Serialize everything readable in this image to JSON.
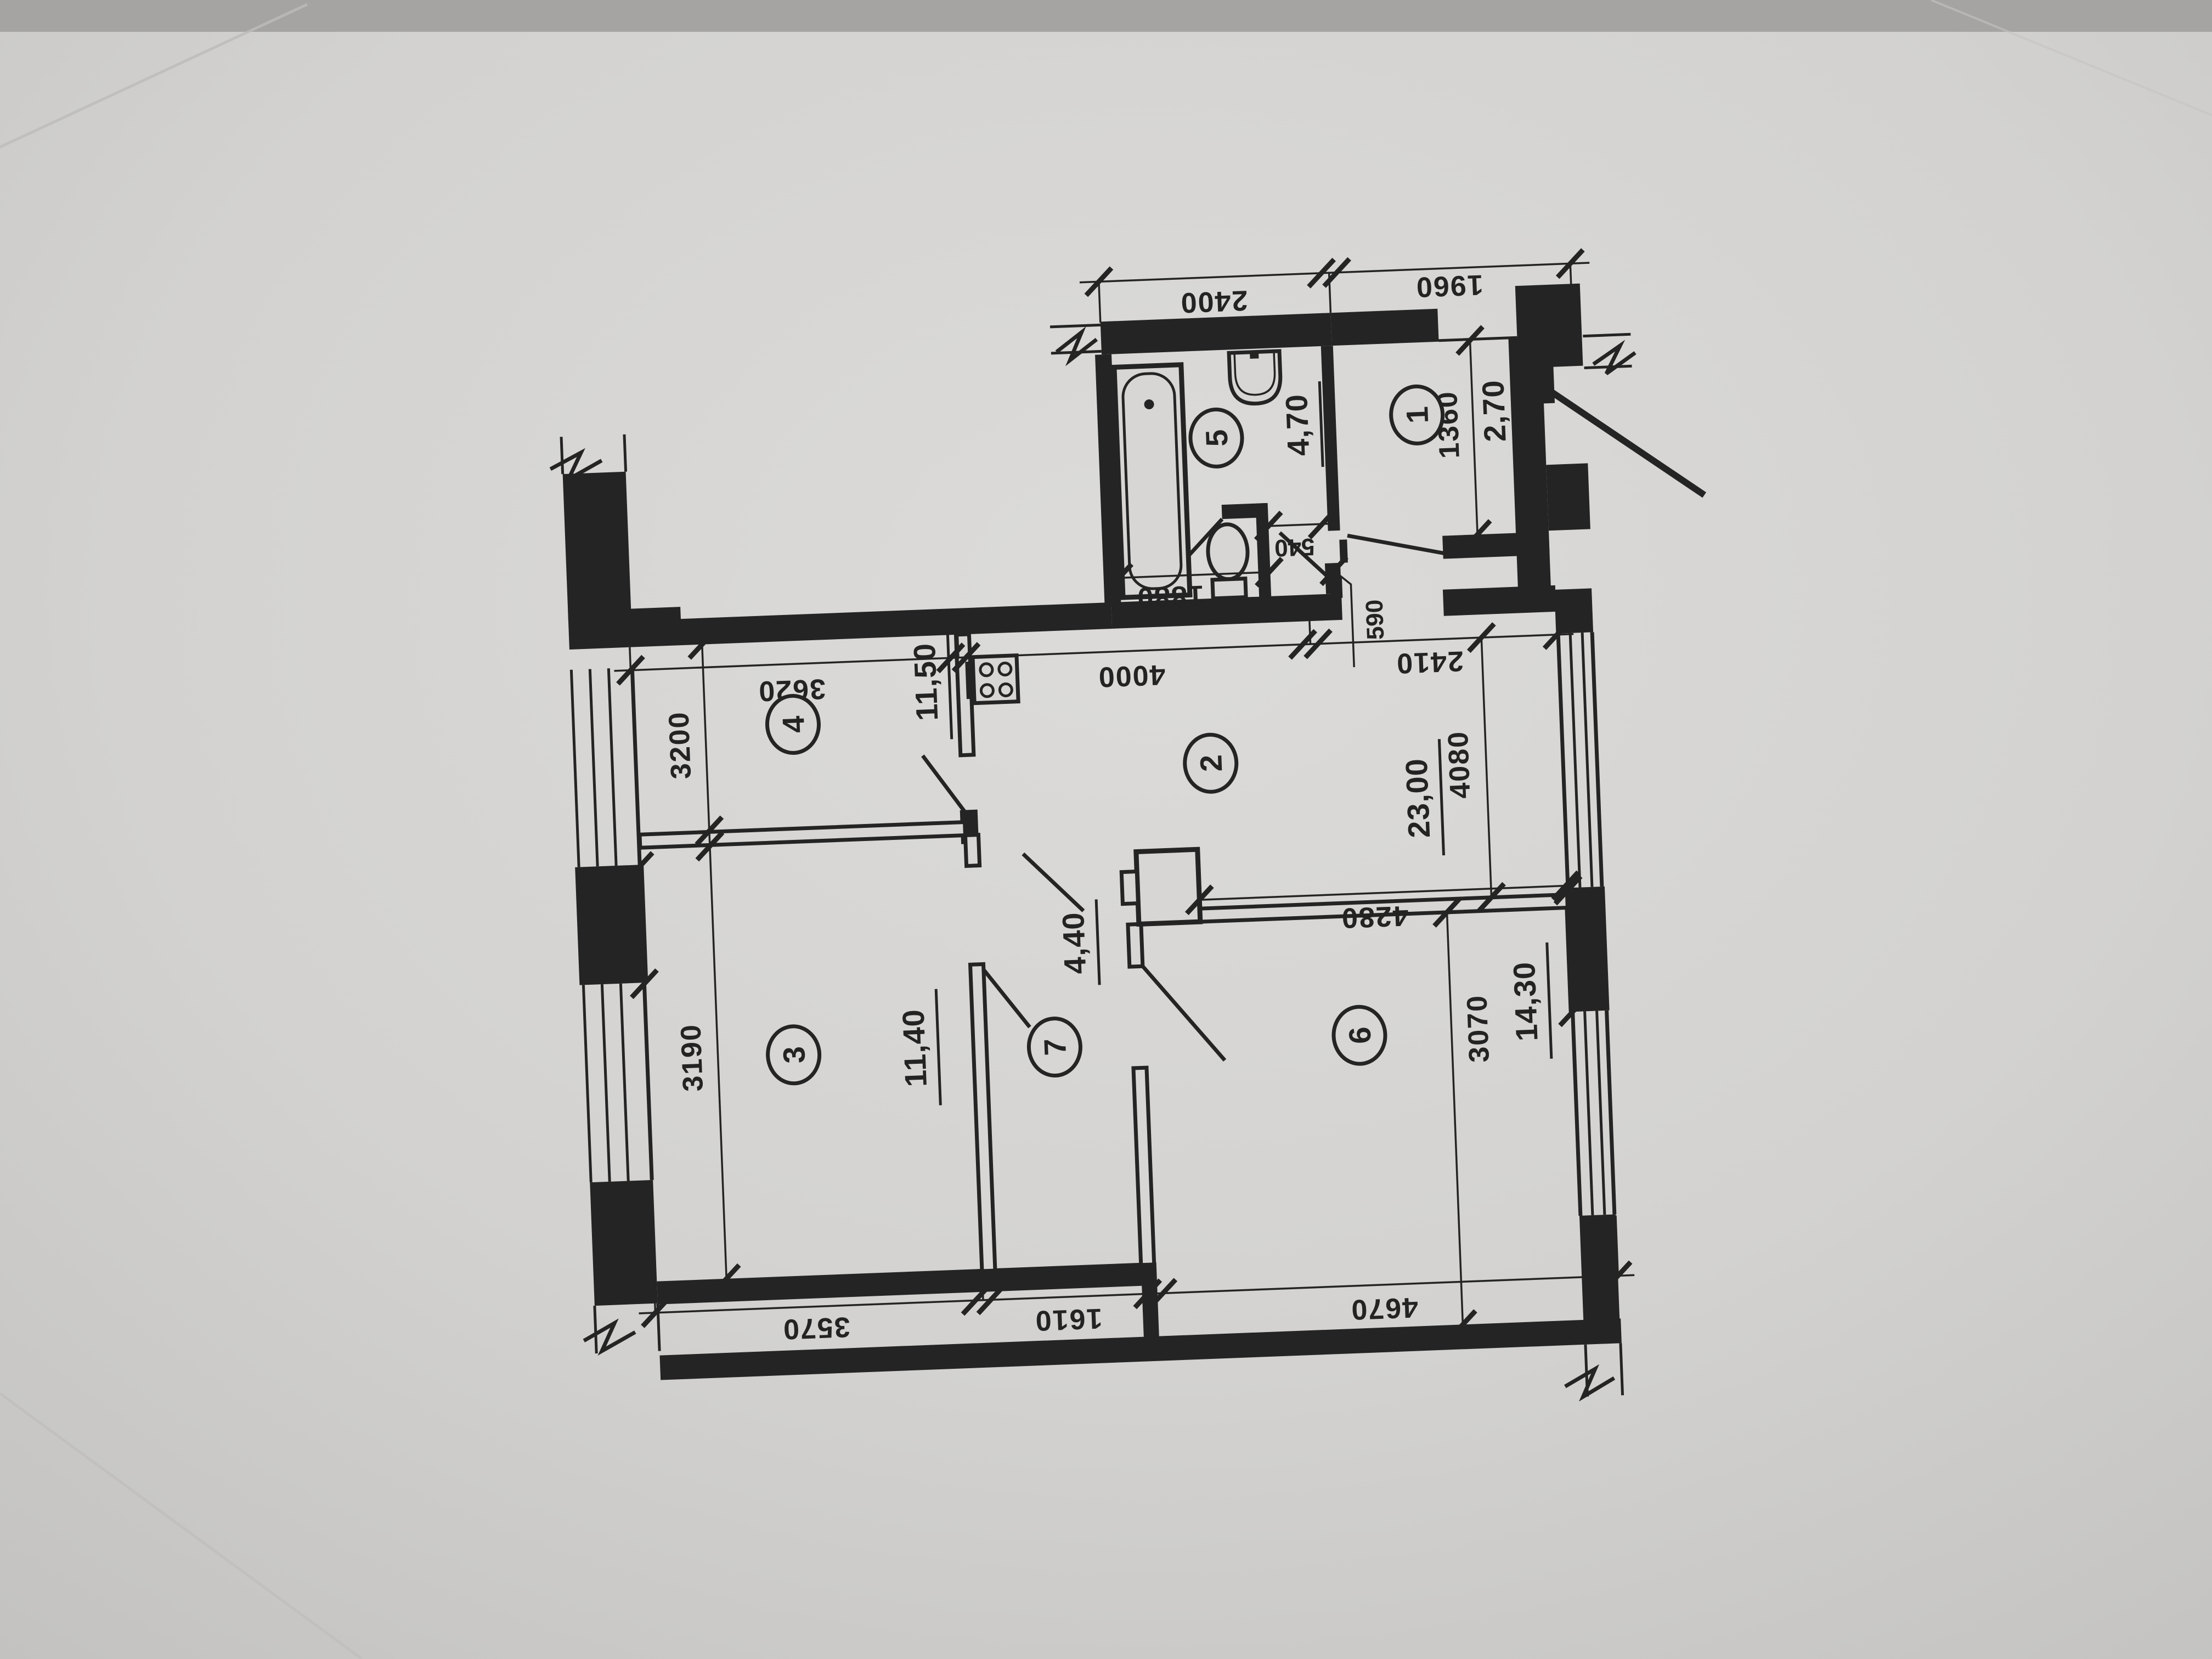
{
  "document": {
    "kind": "photographed architectural floor plan",
    "total_area_note": ""
  },
  "rooms": [
    {
      "number": "1",
      "area": "2,70"
    },
    {
      "number": "2",
      "area": "23,00"
    },
    {
      "number": "3",
      "area": "11,40"
    },
    {
      "number": "4",
      "area": "11,50"
    },
    {
      "number": "5",
      "area": "4,70"
    },
    {
      "number": "6",
      "area": "14,30"
    },
    {
      "number": "7",
      "area": "4,40"
    }
  ],
  "dimensions": {
    "top_row": [
      "2400",
      "1960"
    ],
    "upper_row": [
      "3620",
      "4000",
      "2410"
    ],
    "bottom_row": [
      "3570",
      "1610",
      "4670"
    ],
    "vertical_left": [
      "3200",
      "3190"
    ],
    "vertical_right": [
      "1360",
      "4080",
      "3070"
    ],
    "detail": [
      "540",
      "1880",
      "590",
      "4280"
    ]
  },
  "fixtures": [
    "bathtub",
    "washbasin",
    "toilet",
    "stove",
    "ventilation-shaft"
  ]
}
